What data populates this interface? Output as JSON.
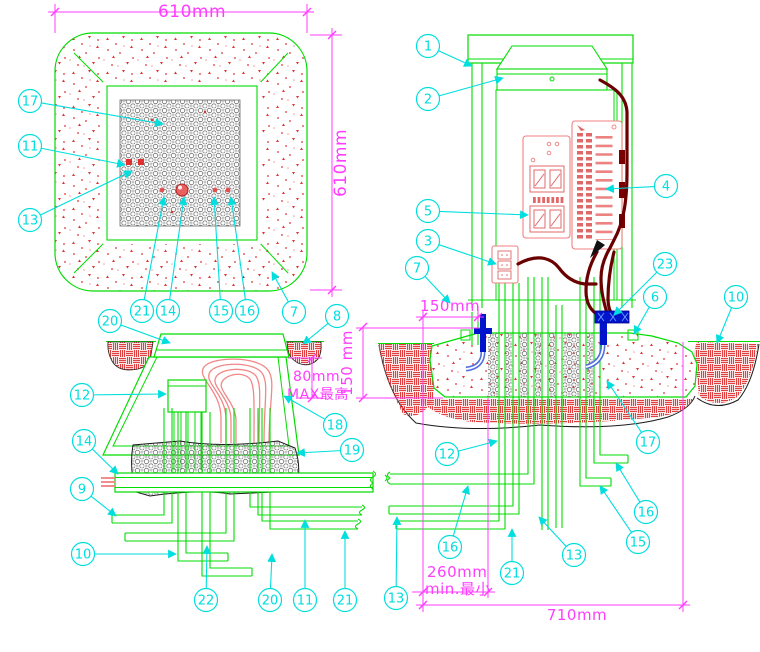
{
  "drawing_title": "cabinet-foundation-installation-detail",
  "colors": {
    "structure_green": "#00DD00",
    "dimension_magenta": "#FF3DFF",
    "callout_cyan": "#00DEDE",
    "concrete_speck_red": "#E03030",
    "pavement_hatch_red": "#E04040",
    "component_pink": "#F08080",
    "cable_dark_red": "#6B0000",
    "ground_blue": "#0014CC",
    "ground_tube_blue": "#4F6FE0",
    "stone_gray": "#777777",
    "soil_black": "#1a1a1a"
  },
  "dimensions": [
    {
      "text": "610mm",
      "x": 192,
      "y": 17,
      "rotate": 0,
      "anchor": "middle",
      "size": 17
    },
    {
      "text": "610mm",
      "x": 346,
      "y": 163,
      "rotate": -90,
      "anchor": "middle",
      "size": 17
    },
    {
      "text": "150mm",
      "x": 450,
      "y": 311,
      "rotate": 0,
      "anchor": "middle",
      "size": 15
    },
    {
      "text": "150 mm",
      "x": 352,
      "y": 363,
      "rotate": -90,
      "anchor": "middle",
      "size": 15
    },
    {
      "text": "80mm",
      "x": 293,
      "y": 381,
      "rotate": 0,
      "anchor": "start",
      "size": 14
    },
    {
      "text": "MAX最高",
      "x": 287,
      "y": 399,
      "rotate": 0,
      "anchor": "start",
      "size": 14
    },
    {
      "text": "260mm",
      "x": 427,
      "y": 577,
      "rotate": 0,
      "anchor": "start",
      "size": 15
    },
    {
      "text": "min.最小",
      "x": 425,
      "y": 594,
      "rotate": 0,
      "anchor": "start",
      "size": 15
    },
    {
      "text": "710mm",
      "x": 577,
      "y": 620,
      "rotate": 0,
      "anchor": "middle",
      "size": 15
    }
  ],
  "callouts": {
    "plan_view": [
      {
        "n": "17",
        "cx": 30,
        "cy": 101,
        "tx": 163,
        "ty": 124
      },
      {
        "n": "11",
        "cx": 30,
        "cy": 146,
        "tx": 125,
        "ty": 165
      },
      {
        "n": "13",
        "cx": 30,
        "cy": 220,
        "tx": 132,
        "ty": 171
      },
      {
        "n": "21",
        "cx": 142,
        "cy": 311,
        "tx": 164,
        "ty": 197
      },
      {
        "n": "14",
        "cx": 168,
        "cy": 311,
        "tx": 184,
        "ty": 197
      },
      {
        "n": "15",
        "cx": 221,
        "cy": 311,
        "tx": 214,
        "ty": 197
      },
      {
        "n": "16",
        "cx": 247,
        "cy": 311,
        "tx": 231,
        "ty": 197
      },
      {
        "n": "7",
        "cx": 294,
        "cy": 312,
        "tx": 272,
        "ty": 272
      },
      {
        "n": "8",
        "cx": 337,
        "cy": 316,
        "tx": 303,
        "ty": 344
      }
    ],
    "section_view": [
      {
        "n": "20",
        "cx": 110,
        "cy": 321,
        "tx": 170,
        "ty": 343
      },
      {
        "n": "12",
        "cx": 82,
        "cy": 395,
        "tx": 166,
        "ty": 394
      },
      {
        "n": "18",
        "cx": 335,
        "cy": 425,
        "tx": 284,
        "ty": 396
      },
      {
        "n": "19",
        "cx": 352,
        "cy": 450,
        "tx": 297,
        "ty": 453
      },
      {
        "n": "14",
        "cx": 84,
        "cy": 441,
        "tx": 118,
        "ty": 474
      },
      {
        "n": "9",
        "cx": 82,
        "cy": 489,
        "tx": 116,
        "ty": 516
      },
      {
        "n": "10",
        "cx": 83,
        "cy": 554,
        "tx": 176,
        "ty": 554
      },
      {
        "n": "22",
        "cx": 206,
        "cy": 600,
        "tx": 207,
        "ty": 546
      },
      {
        "n": "20",
        "cx": 270,
        "cy": 600,
        "tx": 272,
        "ty": 554
      },
      {
        "n": "11",
        "cx": 305,
        "cy": 600,
        "tx": 305,
        "ty": 520
      },
      {
        "n": "21",
        "cx": 345,
        "cy": 600,
        "tx": 345,
        "ty": 531
      },
      {
        "n": "13",
        "cx": 396,
        "cy": 598,
        "tx": 397,
        "ty": 517
      }
    ],
    "elevation_view": [
      {
        "n": "1",
        "cx": 428,
        "cy": 46,
        "tx": 472,
        "ty": 66
      },
      {
        "n": "2",
        "cx": 428,
        "cy": 99,
        "tx": 503,
        "ty": 78
      },
      {
        "n": "5",
        "cx": 428,
        "cy": 211,
        "tx": 528,
        "ty": 215
      },
      {
        "n": "3",
        "cx": 428,
        "cy": 241,
        "tx": 496,
        "ty": 264
      },
      {
        "n": "7",
        "cx": 417,
        "cy": 268,
        "tx": 450,
        "ty": 303
      },
      {
        "n": "4",
        "cx": 666,
        "cy": 186,
        "tx": 606,
        "ty": 189
      },
      {
        "n": "23",
        "cx": 665,
        "cy": 264,
        "tx": 614,
        "ty": 315
      },
      {
        "n": "6",
        "cx": 655,
        "cy": 297,
        "tx": 634,
        "ty": 334
      },
      {
        "n": "10",
        "cx": 736,
        "cy": 297,
        "tx": 717,
        "ty": 343
      },
      {
        "n": "17",
        "cx": 648,
        "cy": 442,
        "tx": 607,
        "ty": 381
      },
      {
        "n": "12",
        "cx": 447,
        "cy": 454,
        "tx": 497,
        "ty": 441
      },
      {
        "n": "16",
        "cx": 450,
        "cy": 547,
        "tx": 468,
        "ty": 486
      },
      {
        "n": "21",
        "cx": 512,
        "cy": 573,
        "tx": 512,
        "ty": 529
      },
      {
        "n": "13",
        "cx": 574,
        "cy": 555,
        "tx": 539,
        "ty": 517
      },
      {
        "n": "15",
        "cx": 638,
        "cy": 542,
        "tx": 600,
        "ty": 486
      },
      {
        "n": "16",
        "cx": 646,
        "cy": 512,
        "tx": 616,
        "ty": 463
      }
    ]
  }
}
